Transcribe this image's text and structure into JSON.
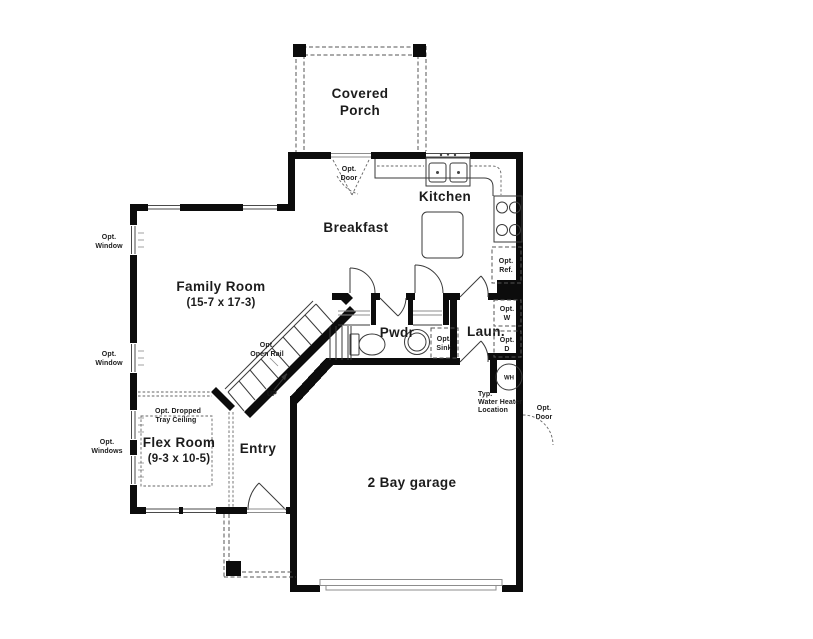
{
  "colors": {
    "background": "#ffffff",
    "wall": "#0c0c0c",
    "thin_line": "#3a3a3a",
    "dashed_line": "#555555",
    "text": "#1c1c1c"
  },
  "rooms": {
    "covered_porch": {
      "line1": "Covered",
      "line2": "Porch"
    },
    "kitchen": {
      "label": "Kitchen"
    },
    "breakfast": {
      "label": "Breakfast"
    },
    "family_room": {
      "label": "Family Room",
      "dims": "(15-7 x 17-3)"
    },
    "powder": {
      "label": "Pwdr"
    },
    "laundry": {
      "label": "Laun."
    },
    "flex_room": {
      "label": "Flex Room",
      "dims": "(9-3 x 10-5)"
    },
    "entry": {
      "label": "Entry"
    },
    "garage": {
      "label": "2 Bay garage"
    }
  },
  "annotations": {
    "opt": "Opt.",
    "door": "Door",
    "window": "Window",
    "windows": "Windows",
    "ref": "Ref.",
    "sink": "Sink",
    "washer": "W",
    "dryer": "D",
    "wh": "WH",
    "up": "UP",
    "open_rail": "Open Rail",
    "opt_dropped": "Opt. Dropped",
    "tray_ceiling": "Tray Ceiling",
    "typ": "Typ.",
    "water_heater": "Water Heater",
    "location": "Location"
  }
}
